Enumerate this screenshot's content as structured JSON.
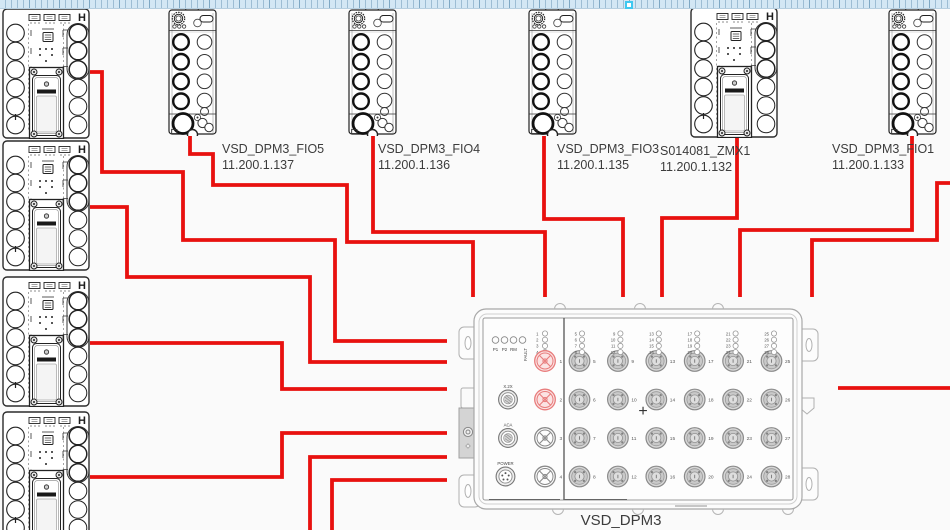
{
  "background": "#fafafa",
  "ruler": {
    "handle_color": "#3fc8f0",
    "strip_color": "#d3e7f4"
  },
  "labels": {
    "h_marker": "H"
  },
  "modules": [
    {
      "id": "fio5",
      "name": "VSD_DPM3_FIO5",
      "ip": "11.200.1.137"
    },
    {
      "id": "fio4",
      "name": "VSD_DPM3_FIO4",
      "ip": "11.200.1.136"
    },
    {
      "id": "fio3",
      "name": "VSD_DPM3_FIO3",
      "ip": "11.200.1.135"
    },
    {
      "id": "zmx1",
      "name": "S014081_ZMX1",
      "ip": "11.200.1.132"
    },
    {
      "id": "fio1",
      "name": "VSD_DPM3_FIO1",
      "ip": "11.200.1.133"
    }
  ],
  "dpm3": {
    "title": "VSD_DPM3",
    "status_leds": [
      "P1",
      "P2",
      "RM",
      "FAULT"
    ],
    "left_led_numbers": [
      "1",
      "2",
      "3",
      "4"
    ],
    "left_ports": [
      {
        "label": "1",
        "highlighted": true
      },
      {
        "label": "2",
        "highlighted": true
      },
      {
        "label": "3",
        "highlighted": false
      },
      {
        "label": "4",
        "highlighted": false
      }
    ],
    "side_connectors": [
      "X.2X",
      "ACA",
      "POWER"
    ],
    "port_columns": [
      [
        "5",
        "6",
        "7",
        "8"
      ],
      [
        "9",
        "10",
        "11",
        "12"
      ],
      [
        "13",
        "14",
        "15",
        "16"
      ],
      [
        "17",
        "18",
        "19",
        "20"
      ],
      [
        "21",
        "22",
        "23",
        "24"
      ],
      [
        "25",
        "26",
        "27",
        "28"
      ]
    ],
    "center_mark": "+",
    "highlight_color": "#e87c7c"
  },
  "wires": {
    "color": "#e8110f",
    "width": 3.8,
    "paths": [
      {
        "id": "terminal1-to-dpm3",
        "points": [
          [
            90,
            72
          ],
          [
            102,
            72
          ],
          [
            102,
            172
          ],
          [
            183,
            172
          ],
          [
            183,
            240
          ],
          [
            335,
            240
          ],
          [
            335,
            341
          ],
          [
            447,
            341
          ]
        ]
      },
      {
        "id": "terminal2-to-dpm3",
        "points": [
          [
            90,
            207
          ],
          [
            127,
            207
          ],
          [
            127,
            277
          ],
          [
            310,
            277
          ],
          [
            310,
            362
          ],
          [
            447,
            362
          ]
        ]
      },
      {
        "id": "terminal3-to-dpm3",
        "points": [
          [
            90,
            343
          ],
          [
            282,
            343
          ],
          [
            282,
            389
          ],
          [
            447,
            389
          ]
        ]
      },
      {
        "id": "terminal4-to-dpm3",
        "points": [
          [
            90,
            477
          ],
          [
            282,
            477
          ],
          [
            282,
            433
          ],
          [
            447,
            433
          ]
        ]
      },
      {
        "id": "offscreen-bottom-a",
        "points": [
          [
            310,
            532
          ],
          [
            310,
            457
          ],
          [
            447,
            457
          ]
        ]
      },
      {
        "id": "offscreen-bottom-b",
        "points": [
          [
            332,
            532
          ],
          [
            332,
            480
          ],
          [
            447,
            480
          ]
        ]
      },
      {
        "id": "fio5-to-dpm3",
        "points": [
          [
            190,
            136
          ],
          [
            190,
            154
          ],
          [
            213,
            154
          ],
          [
            213,
            185
          ],
          [
            347,
            185
          ],
          [
            347,
            242
          ],
          [
            473,
            242
          ],
          [
            473,
            297
          ]
        ]
      },
      {
        "id": "fio4-to-dpm3",
        "points": [
          [
            373,
            136
          ],
          [
            373,
            232
          ],
          [
            545,
            232
          ],
          [
            545,
            297
          ]
        ]
      },
      {
        "id": "fio3-to-dpm3",
        "points": [
          [
            544,
            136
          ],
          [
            544,
            219
          ],
          [
            623,
            219
          ],
          [
            623,
            297
          ]
        ]
      },
      {
        "id": "zmx1-to-dpm3",
        "points": [
          [
            737,
            138
          ],
          [
            737,
            218
          ],
          [
            662,
            218
          ],
          [
            662,
            297
          ]
        ]
      },
      {
        "id": "fio1-to-dpm3",
        "points": [
          [
            912,
            136
          ],
          [
            912,
            230
          ],
          [
            740,
            230
          ],
          [
            740,
            297
          ]
        ]
      },
      {
        "id": "offscreen-right-top",
        "points": [
          [
            952,
            183
          ],
          [
            937,
            183
          ],
          [
            937,
            240
          ],
          [
            812,
            240
          ],
          [
            812,
            297
          ]
        ]
      },
      {
        "id": "dpm3-to-offscreen-right",
        "points": [
          [
            838,
            388
          ],
          [
            952,
            388
          ]
        ]
      }
    ]
  }
}
